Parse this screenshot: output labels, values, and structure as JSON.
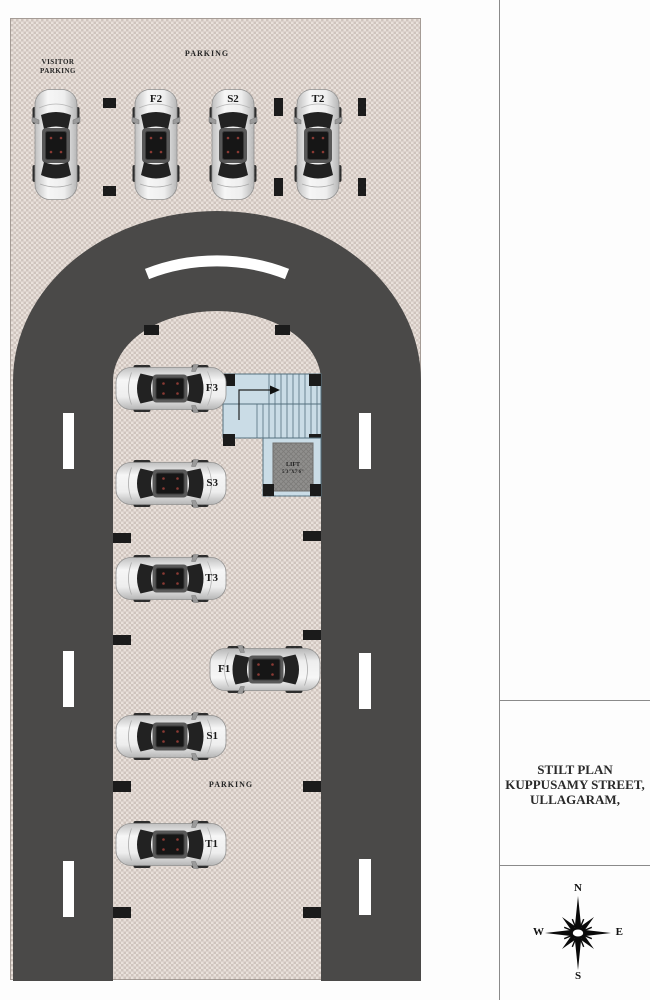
{
  "colors": {
    "road": "#4a4948",
    "floor": "#d9cfc9",
    "marker": "#1b1b1b",
    "stair_fill": "#cadce6",
    "stair_line": "#54707e",
    "lift_fill": "#908f8d",
    "divider_line": "#8a8a8a",
    "text": "#262626"
  },
  "plan": {
    "labels": {
      "parking_top": "PARKING",
      "visitor_line1": "VISITOR",
      "visitor_line2": "PARKING",
      "parking_bottom": "PARKING"
    },
    "lift": {
      "name": "LIFT",
      "size": "5'3\"X7'6\""
    },
    "stalls": {
      "f2": "F2",
      "s2": "S2",
      "t2": "T2",
      "f3": "F3",
      "s3": "S3",
      "t3": "T3",
      "f1": "F1",
      "s1": "S1",
      "t1": "T1"
    }
  },
  "panel": {
    "title_line1": "STILT PLAN",
    "title_line2": "KUPPUSAMY STREET,",
    "title_line3": "ULLAGARAM,",
    "compass": {
      "n": "N",
      "e": "E",
      "s": "S",
      "w": "W"
    }
  }
}
